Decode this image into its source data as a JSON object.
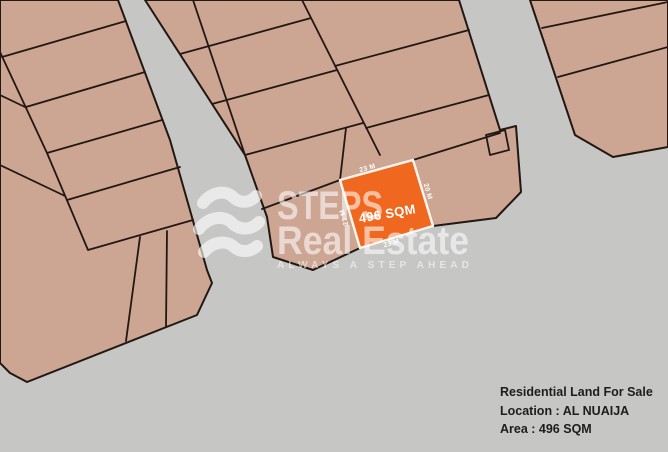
{
  "info_panel": {
    "title": "Residential Land For Sale",
    "location": "Location : AL NUAIJA",
    "area": "Area : 496 SQM"
  },
  "highlighted_plot": {
    "area_label": "496 SQM",
    "dim_top": "23 M",
    "dim_right": "20 M",
    "dim_bottom": "23 M",
    "dim_left": "21 M"
  },
  "watermark": {
    "brand_top": "STEPS",
    "brand_bottom": "Real Estate",
    "tagline": "ALWAYS A STEP AHEAD"
  },
  "colors": {
    "background": "#c6c6c5",
    "parcel_fill": "#cda593",
    "parcel_border": "#221813",
    "highlight_fill": "#f0681f",
    "highlight_border": "#fdf6ee",
    "info_text": "#1d1d1d",
    "watermark": "#ffffff"
  }
}
